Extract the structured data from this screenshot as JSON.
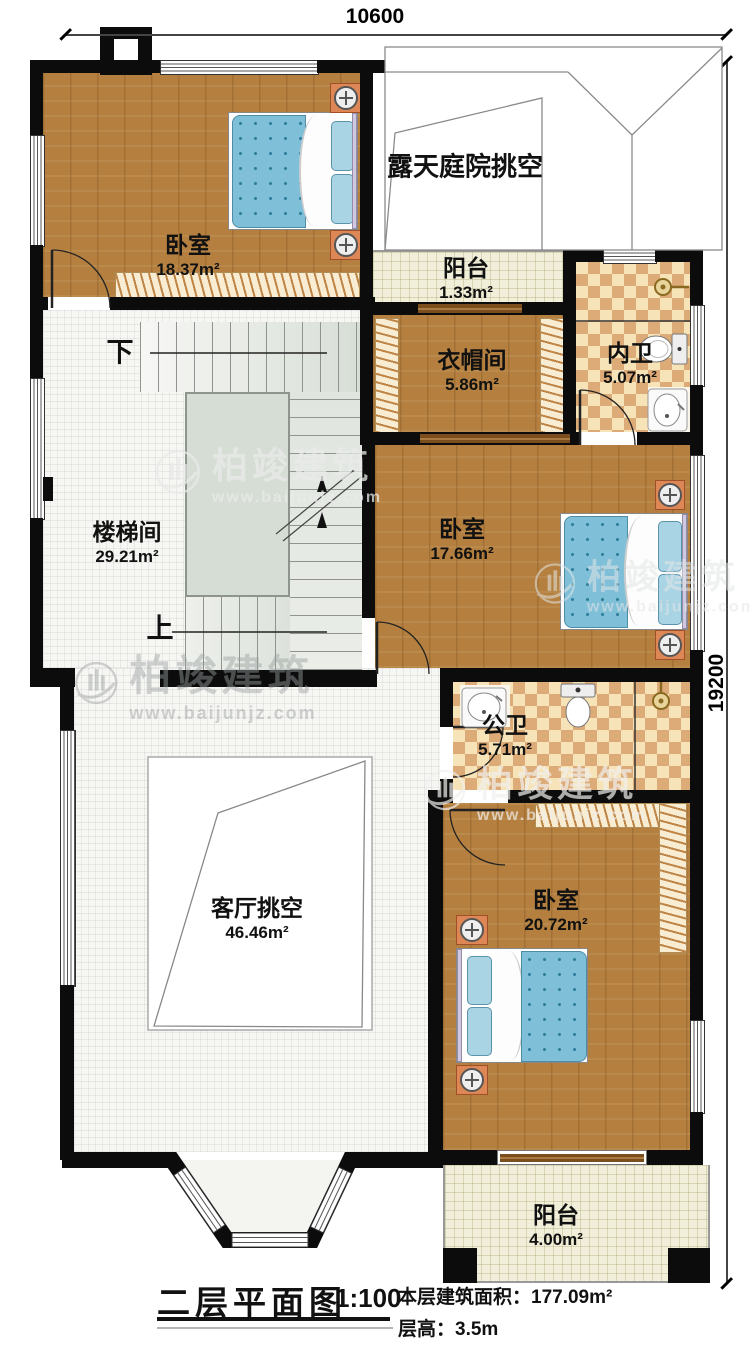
{
  "dimensions": {
    "top": "10600",
    "right": "19200"
  },
  "rooms": {
    "bedroom1": {
      "name": "卧室",
      "area": "18.37m²"
    },
    "courtyard": {
      "name": "露天庭院挑空"
    },
    "balcony1": {
      "name": "阳台",
      "area": "1.33m²"
    },
    "cloakroom": {
      "name": "衣帽间",
      "area": "5.86m²"
    },
    "ensuite": {
      "name": "内卫",
      "area": "5.07m²"
    },
    "stairwell": {
      "name": "楼梯间",
      "area": "29.21m²"
    },
    "bedroom2": {
      "name": "卧室",
      "area": "17.66m²"
    },
    "public_bath": {
      "name": "公卫",
      "area": "5.71m²"
    },
    "living_void": {
      "name": "客厅挑空",
      "area": "46.46m²"
    },
    "bedroom3": {
      "name": "卧室",
      "area": "20.72m²"
    },
    "balcony2": {
      "name": "阳台",
      "area": "4.00m²"
    }
  },
  "stairs": {
    "down": "下",
    "up": "上"
  },
  "watermark": {
    "name": "柏竣建筑",
    "url": "www.baijunjz.com"
  },
  "title_block": {
    "title": "二层平面图",
    "scale": "1:100",
    "floor_area": "本层建筑面积：177.09m²",
    "floor_height": "层高：3.5m"
  },
  "colors": {
    "wall": "#0c0c0c",
    "wood_floor": "#b5803f",
    "tile_cream": "#f1eeda",
    "checker_light": "#f6e3b8",
    "checker_dark": "#ddab78",
    "mattress_blue": "#7fc0d8",
    "nightstand_orange": "#dd8757",
    "stair_landing": "#d6ddd5"
  }
}
